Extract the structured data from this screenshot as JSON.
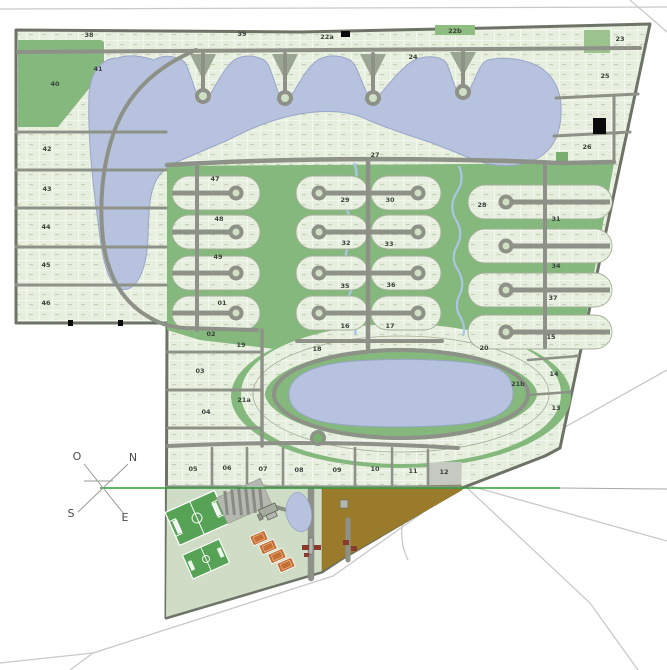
{
  "map": {
    "type": "residential-master-plan",
    "colors": {
      "lot_fill": "#e6eedd",
      "lot_grid": "#ffffff",
      "block_border": "#a3ae98",
      "green_space": "#85b87c",
      "amenity_green": "#cfdcc6",
      "lake": "#b7c2de",
      "creek": "#a9c6e4",
      "road": "#8d9187",
      "perimeter": "#6e7367",
      "external_road": "#c9c9c9",
      "brown_field": "#9a7b2b",
      "tennis_court": "#c56f35",
      "soccer_field": "#57a356",
      "sold_lot": "#0a0a0a",
      "survey_line_green": "#2f9e38"
    },
    "compass": {
      "points": [
        {
          "label": "O",
          "x": 77,
          "y": 460
        },
        {
          "label": "N",
          "x": 133,
          "y": 461
        },
        {
          "label": "S",
          "x": 71,
          "y": 517
        },
        {
          "label": "E",
          "x": 125,
          "y": 521
        }
      ]
    },
    "sections": [
      {
        "label": "38",
        "x": 89,
        "y": 37
      },
      {
        "label": "39",
        "x": 242,
        "y": 36
      },
      {
        "label": "22a",
        "x": 327,
        "y": 39
      },
      {
        "label": "22b",
        "x": 455,
        "y": 33
      },
      {
        "label": "23",
        "x": 620,
        "y": 41
      },
      {
        "label": "24",
        "x": 413,
        "y": 59
      },
      {
        "label": "25",
        "x": 605,
        "y": 78
      },
      {
        "label": "26",
        "x": 587,
        "y": 149
      },
      {
        "label": "40",
        "x": 55,
        "y": 86
      },
      {
        "label": "41",
        "x": 98,
        "y": 71
      },
      {
        "label": "42",
        "x": 47,
        "y": 151
      },
      {
        "label": "43",
        "x": 47,
        "y": 191
      },
      {
        "label": "44",
        "x": 46,
        "y": 229
      },
      {
        "label": "45",
        "x": 46,
        "y": 267
      },
      {
        "label": "46",
        "x": 46,
        "y": 305
      },
      {
        "label": "47",
        "x": 215,
        "y": 181
      },
      {
        "label": "48",
        "x": 219,
        "y": 221
      },
      {
        "label": "49",
        "x": 218,
        "y": 259
      },
      {
        "label": "27",
        "x": 375,
        "y": 157
      },
      {
        "label": "28",
        "x": 482,
        "y": 207
      },
      {
        "label": "29",
        "x": 345,
        "y": 202
      },
      {
        "label": "30",
        "x": 390,
        "y": 202
      },
      {
        "label": "31",
        "x": 556,
        "y": 221
      },
      {
        "label": "32",
        "x": 346,
        "y": 245
      },
      {
        "label": "33",
        "x": 389,
        "y": 246
      },
      {
        "label": "34",
        "x": 556,
        "y": 268
      },
      {
        "label": "35",
        "x": 345,
        "y": 288
      },
      {
        "label": "36",
        "x": 391,
        "y": 287
      },
      {
        "label": "37",
        "x": 553,
        "y": 300
      },
      {
        "label": "16",
        "x": 345,
        "y": 328
      },
      {
        "label": "17",
        "x": 390,
        "y": 328
      },
      {
        "label": "18",
        "x": 317,
        "y": 351
      },
      {
        "label": "19",
        "x": 241,
        "y": 347
      },
      {
        "label": "20",
        "x": 484,
        "y": 350
      },
      {
        "label": "21a",
        "x": 244,
        "y": 402
      },
      {
        "label": "21b",
        "x": 518,
        "y": 386
      },
      {
        "label": "15",
        "x": 551,
        "y": 339
      },
      {
        "label": "14",
        "x": 554,
        "y": 376
      },
      {
        "label": "13",
        "x": 556,
        "y": 410
      },
      {
        "label": "01",
        "x": 222,
        "y": 305
      },
      {
        "label": "02",
        "x": 211,
        "y": 336
      },
      {
        "label": "03",
        "x": 200,
        "y": 373
      },
      {
        "label": "04",
        "x": 206,
        "y": 414
      },
      {
        "label": "05",
        "x": 193,
        "y": 471
      },
      {
        "label": "06",
        "x": 227,
        "y": 470
      },
      {
        "label": "07",
        "x": 263,
        "y": 471
      },
      {
        "label": "08",
        "x": 299,
        "y": 472
      },
      {
        "label": "09",
        "x": 337,
        "y": 472
      },
      {
        "label": "10",
        "x": 375,
        "y": 471
      },
      {
        "label": "11",
        "x": 413,
        "y": 473
      },
      {
        "label": "12",
        "x": 444,
        "y": 474
      }
    ]
  }
}
